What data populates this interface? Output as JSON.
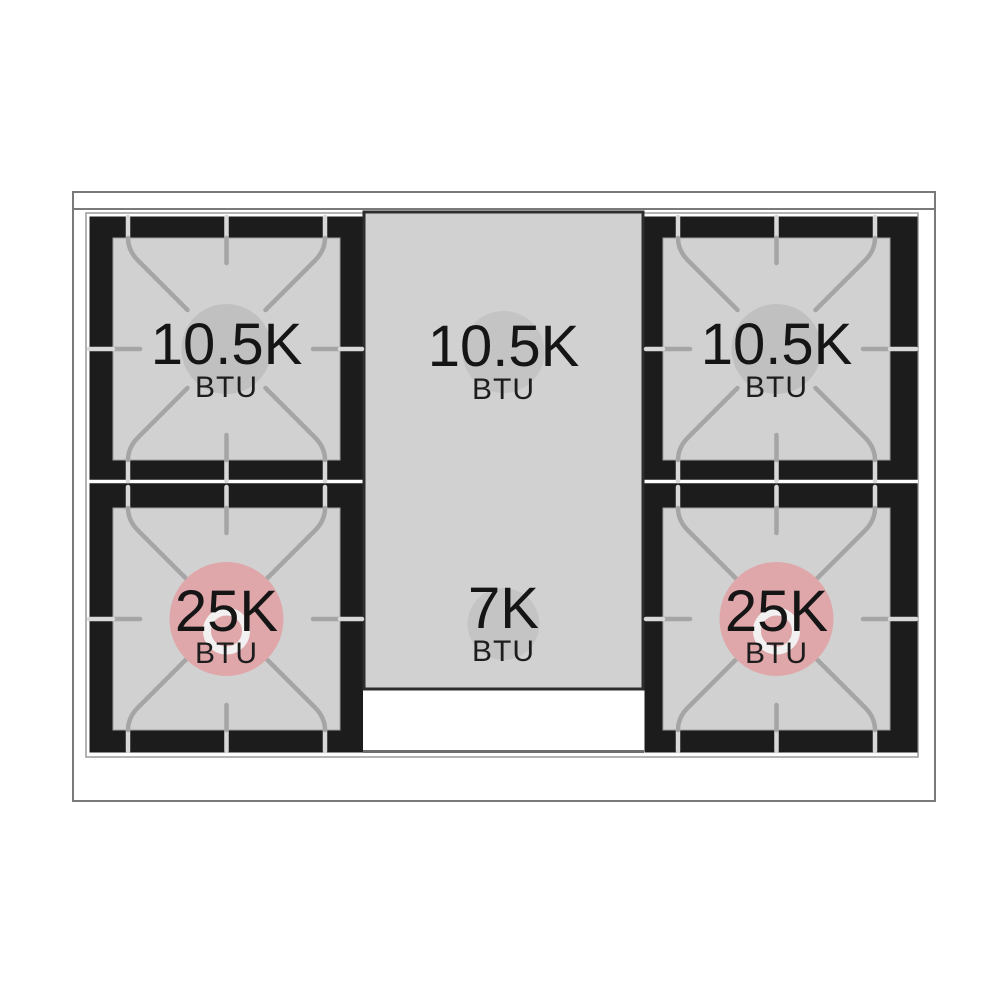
{
  "burners": [
    {
      "position": "top-left",
      "value": "10.5K",
      "unit": "BTU"
    },
    {
      "position": "top-center",
      "value": "10.5K",
      "unit": "BTU"
    },
    {
      "position": "top-right",
      "value": "10.5K",
      "unit": "BTU"
    },
    {
      "position": "bottom-left",
      "value": "25K",
      "unit": "BTU"
    },
    {
      "position": "bottom-center",
      "value": "7K",
      "unit": "BTU"
    },
    {
      "position": "bottom-right",
      "value": "25K",
      "unit": "BTU"
    }
  ],
  "colors": {
    "frame_black": "#1c1c1c",
    "burner_surface_gray": "#d1d1d1",
    "burner_circle_gray": "#c0c0c0",
    "accent_pink": "#dfa7aa",
    "ring_white": "#f2f0f0",
    "grate_line_gray": "#a5a5a5",
    "grate_line_light": "#d8d8d8",
    "text_black": "#151515"
  }
}
